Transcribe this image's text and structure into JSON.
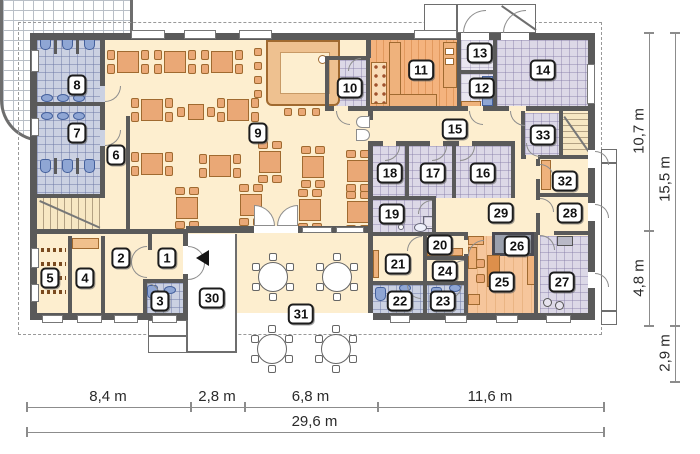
{
  "plan": {
    "type": "architectural-floor-plan",
    "room_labels": [
      {
        "number": "1",
        "x": 167,
        "y": 258
      },
      {
        "number": "2",
        "x": 121,
        "y": 258
      },
      {
        "number": "3",
        "x": 160,
        "y": 301
      },
      {
        "number": "4",
        "x": 85,
        "y": 278
      },
      {
        "number": "5",
        "x": 50,
        "y": 278
      },
      {
        "number": "6",
        "x": 116,
        "y": 155
      },
      {
        "number": "7",
        "x": 77,
        "y": 133
      },
      {
        "number": "8",
        "x": 77,
        "y": 85
      },
      {
        "number": "9",
        "x": 258,
        "y": 133
      },
      {
        "number": "10",
        "x": 350,
        "y": 88
      },
      {
        "number": "11",
        "x": 421,
        "y": 70
      },
      {
        "number": "12",
        "x": 482,
        "y": 88
      },
      {
        "number": "13",
        "x": 480,
        "y": 53
      },
      {
        "number": "14",
        "x": 543,
        "y": 70
      },
      {
        "number": "15",
        "x": 455,
        "y": 129
      },
      {
        "number": "16",
        "x": 483,
        "y": 173
      },
      {
        "number": "17",
        "x": 433,
        "y": 173
      },
      {
        "number": "18",
        "x": 390,
        "y": 173
      },
      {
        "number": "19",
        "x": 392,
        "y": 214
      },
      {
        "number": "20",
        "x": 440,
        "y": 245
      },
      {
        "number": "21",
        "x": 398,
        "y": 264
      },
      {
        "number": "22",
        "x": 400,
        "y": 301
      },
      {
        "number": "23",
        "x": 443,
        "y": 301
      },
      {
        "number": "24",
        "x": 445,
        "y": 271
      },
      {
        "number": "25",
        "x": 502,
        "y": 282
      },
      {
        "number": "26",
        "x": 517,
        "y": 246
      },
      {
        "number": "27",
        "x": 562,
        "y": 282
      },
      {
        "number": "28",
        "x": 570,
        "y": 213
      },
      {
        "number": "29",
        "x": 501,
        "y": 213
      },
      {
        "number": "30",
        "x": 212,
        "y": 298
      },
      {
        "number": "31",
        "x": 301,
        "y": 314
      },
      {
        "number": "32",
        "x": 565,
        "y": 181
      },
      {
        "number": "33",
        "x": 543,
        "y": 135
      }
    ],
    "dimensions": {
      "bottom_segments": [
        {
          "label": "8,4 m",
          "from_x": 26,
          "to_x": 190
        },
        {
          "label": "2,8 m",
          "from_x": 190,
          "to_x": 244
        },
        {
          "label": "6,8 m",
          "from_x": 244,
          "to_x": 377
        },
        {
          "label": "11,6 m",
          "from_x": 377,
          "to_x": 603
        }
      ],
      "bottom_total": {
        "label": "29,6 m",
        "from_x": 26,
        "to_x": 603
      },
      "right_inner_segments": [
        {
          "label": "10,7 m",
          "from_y": 32,
          "to_y": 230
        },
        {
          "label": "4,8 m",
          "from_y": 230,
          "to_y": 325
        }
      ],
      "right_outer_segments": [
        {
          "label": "15,5 m",
          "from_y": 32,
          "to_y": 325
        },
        {
          "label": "2,9 m",
          "from_y": 325,
          "to_y": 381
        }
      ]
    },
    "furniture": {
      "dining_tables": [
        {
          "x": 128,
          "y": 62,
          "o": "h"
        },
        {
          "x": 175,
          "y": 62,
          "o": "h"
        },
        {
          "x": 222,
          "y": 62,
          "o": "h"
        },
        {
          "x": 152,
          "y": 110,
          "o": "h"
        },
        {
          "x": 196,
          "y": 112,
          "o": "s"
        },
        {
          "x": 238,
          "y": 110,
          "o": "h"
        },
        {
          "x": 152,
          "y": 164,
          "o": "h"
        },
        {
          "x": 220,
          "y": 166,
          "o": "h"
        },
        {
          "x": 187,
          "y": 208,
          "o": "v"
        },
        {
          "x": 251,
          "y": 205,
          "o": "v"
        },
        {
          "x": 270,
          "y": 162,
          "o": "v"
        },
        {
          "x": 313,
          "y": 167,
          "o": "v"
        },
        {
          "x": 358,
          "y": 171,
          "o": "v"
        },
        {
          "x": 310,
          "y": 210,
          "o": "v"
        },
        {
          "x": 358,
          "y": 212,
          "o": "v"
        }
      ],
      "terrace_tables": [
        {
          "x": 273,
          "y": 277
        },
        {
          "x": 337,
          "y": 277
        },
        {
          "x": 272,
          "y": 349
        },
        {
          "x": 336,
          "y": 349
        }
      ],
      "bar_stools": [
        {
          "x": 258,
          "y": 52
        },
        {
          "x": 258,
          "y": 66
        },
        {
          "x": 258,
          "y": 80
        },
        {
          "x": 258,
          "y": 94
        },
        {
          "x": 288,
          "y": 112
        },
        {
          "x": 302,
          "y": 112
        },
        {
          "x": 316,
          "y": 112
        }
      ],
      "toilets": [
        {
          "x": 45,
          "y": 43
        },
        {
          "x": 67,
          "y": 43
        },
        {
          "x": 89,
          "y": 43
        },
        {
          "x": 45,
          "y": 166
        },
        {
          "x": 67,
          "y": 166
        },
        {
          "x": 89,
          "y": 166
        },
        {
          "x": 152,
          "y": 292
        },
        {
          "x": 380,
          "y": 294
        },
        {
          "x": 436,
          "y": 294
        }
      ],
      "sinks": [
        {
          "x": 47,
          "y": 98
        },
        {
          "x": 63,
          "y": 98
        },
        {
          "x": 79,
          "y": 98
        },
        {
          "x": 47,
          "y": 116
        },
        {
          "x": 63,
          "y": 116
        },
        {
          "x": 79,
          "y": 116
        },
        {
          "x": 170,
          "y": 290
        },
        {
          "x": 405,
          "y": 288
        },
        {
          "x": 455,
          "y": 288
        }
      ]
    }
  }
}
